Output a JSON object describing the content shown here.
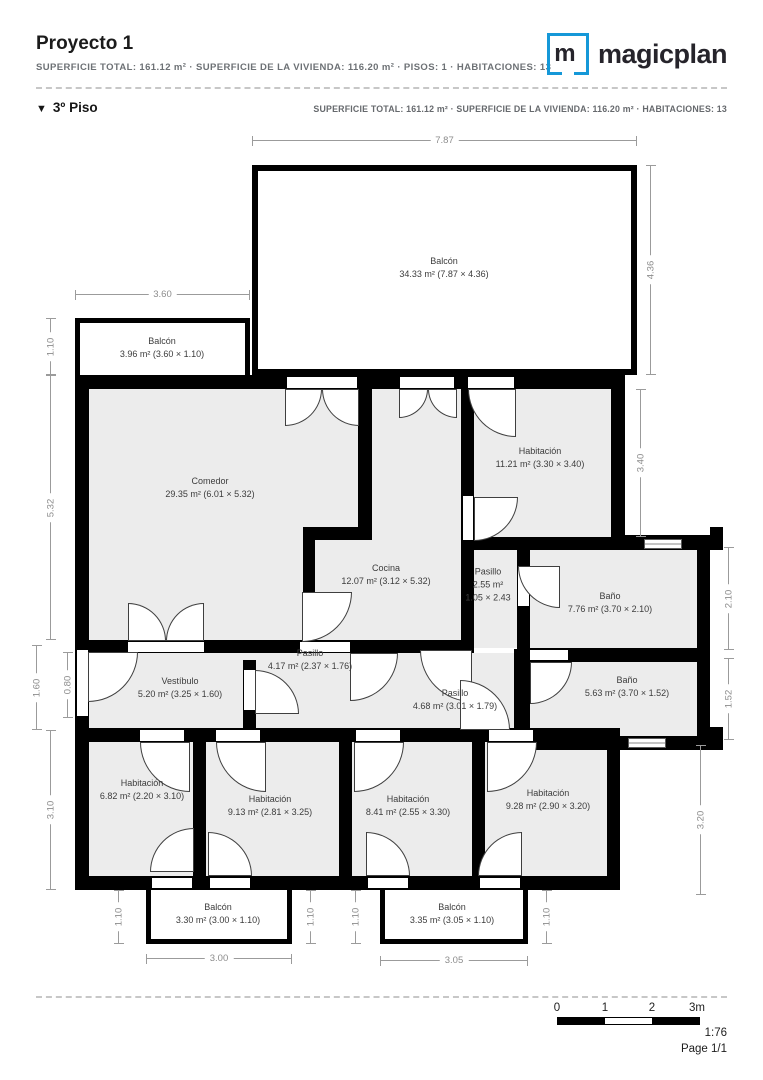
{
  "header": {
    "title": "Proyecto 1",
    "subtitle": "SUPERFICIE TOTAL: 161.12 m² · SUPERFICIE DE LA VIVIENDA: 116.20 m² · PISOS: 1 · HABITACIONES: 13",
    "brand": "magicplan",
    "brand_mark": "m"
  },
  "floor": {
    "marker": "▼",
    "label": "3º Piso",
    "subtitle": "SUPERFICIE TOTAL: 161.12 m² · SUPERFICIE DE LA VIVIENDA: 116.20 m² · HABITACIONES: 13"
  },
  "rooms": {
    "balcon_top": {
      "name": "Balcón",
      "size": "34.33 m² (7.87 × 4.36)"
    },
    "balcon_left": {
      "name": "Balcón",
      "size": "3.96 m² (3.60 × 1.10)"
    },
    "comedor": {
      "name": "Comedor",
      "size": "29.35 m² (6.01 × 5.32)"
    },
    "habitacion_ne": {
      "name": "Habitación",
      "size": "11.21 m² (3.30 × 3.40)"
    },
    "cocina": {
      "name": "Cocina",
      "size": "12.07 m² (3.12 × 5.32)"
    },
    "pasillo_small": {
      "name": "Pasillo",
      "size": "2.55 m²",
      "size2": "1.05 × 2.43"
    },
    "bano_top": {
      "name": "Baño",
      "size": "7.76 m² (3.70 × 2.10)"
    },
    "pasillo_mid": {
      "name": "Pasillo",
      "size": "4.17 m² (2.37 × 1.76)"
    },
    "vestibulo": {
      "name": "Vestíbulo",
      "size": "5.20 m² (3.25 × 1.60)"
    },
    "pasillo_lower": {
      "name": "Pasillo",
      "size": "4.68 m² (3.01 × 1.79)"
    },
    "bano_bottom": {
      "name": "Baño",
      "size": "5.63 m² (3.70 × 1.52)"
    },
    "habitacion_sw": {
      "name": "Habitación",
      "size": "6.82 m² (2.20 × 3.10)"
    },
    "habitacion_s2": {
      "name": "Habitación",
      "size": "9.13 m² (2.81 × 3.25)"
    },
    "habitacion_s3": {
      "name": "Habitación",
      "size": "8.41 m² (2.55 × 3.30)"
    },
    "habitacion_se": {
      "name": "Habitación",
      "size": "9.28 m² (2.90 × 3.20)"
    },
    "balcon_s1": {
      "name": "Balcón",
      "size": "3.30 m² (3.00 × 1.10)"
    },
    "balcon_s2": {
      "name": "Balcón",
      "size": "3.35 m² (3.05 × 1.10)"
    }
  },
  "dimensions": {
    "d787": "7.87",
    "d360": "3.60",
    "d436": "4.36",
    "d110": "1.10",
    "d532": "5.32",
    "d340": "3.40",
    "d210": "2.10",
    "d152": "1.52",
    "d160": "1.60",
    "d080": "0.80",
    "d310": "3.10",
    "d320": "3.20",
    "d300": "3.00",
    "d305": "3.05"
  },
  "footer": {
    "scale_ticks": [
      "0",
      "1",
      "2",
      "3m"
    ],
    "scale_ratio": "1:76",
    "page": "Page 1/1"
  },
  "colors": {
    "brand_blue": "#1598d8",
    "room_fill": "#ececec",
    "wall": "#000000",
    "dim_line": "#9b9b9b"
  }
}
